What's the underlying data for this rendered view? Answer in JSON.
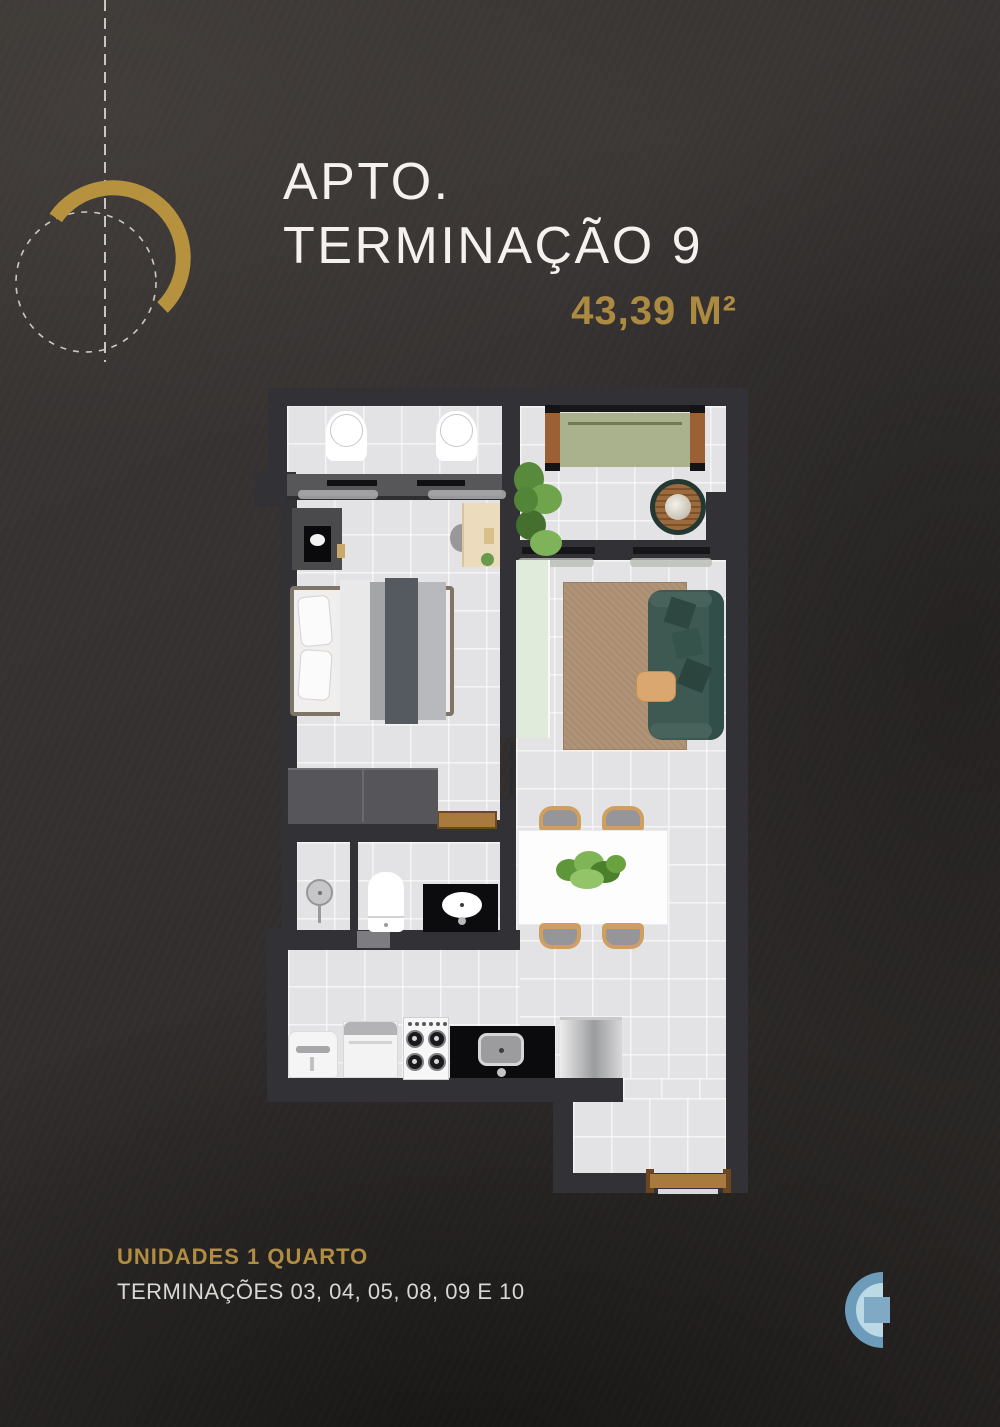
{
  "header": {
    "title_line1": "APTO.",
    "title_line2": "TERMINAÇÃO 9",
    "area": "43,39 M²"
  },
  "footer": {
    "line1": "UNIDADES 1 QUARTO",
    "line2": "TERMINAÇÕES 03, 04, 05, 08, 09 E 10"
  },
  "colors": {
    "gold": "#b6923f",
    "gold_text": "#ac8a41",
    "background": "#34302e",
    "title_white": "#f4f2ee",
    "footer_secondary": "#d9d7d3",
    "wall": "#323236",
    "floor": "#e3e3e5",
    "balcony_cushion": "#a9b28c",
    "sofa_teal": "#3e5852",
    "rug_tan": "#b19478",
    "wood": "#a87a3e",
    "logo_outer_blue": "#6d9cbb",
    "logo_inner_blue": "#bcdae6",
    "logo_square_blue": "#7fa9c5"
  },
  "decor_icons": [
    "gold-arc",
    "dashed-circle",
    "vertical-dashed-line"
  ],
  "floorplan": {
    "description": "one-bedroom apartment floor plan, top-down view",
    "furniture": [
      "lounge-chair",
      "lounge-chair",
      "garden-bench",
      "round-side-table",
      "potted-plant",
      "tv-panel",
      "television",
      "double-bed",
      "desk",
      "desk-chair",
      "wardrobe",
      "sideboard",
      "rug",
      "sofa",
      "throw-pillows",
      "side-table",
      "dining-table",
      "centerpiece-plant",
      "dining-chair",
      "dining-chair",
      "dining-chair",
      "dining-chair",
      "shower-head",
      "toilet",
      "bathroom-vanity-sink",
      "laundry-tub",
      "washing-machine",
      "gas-stove",
      "kitchen-sink-counter",
      "refrigerator",
      "balcony-sliding-door",
      "bedroom-windows",
      "bathroom-door",
      "entry-door-threshold"
    ]
  },
  "logo_icon": "c-monogram-logo"
}
